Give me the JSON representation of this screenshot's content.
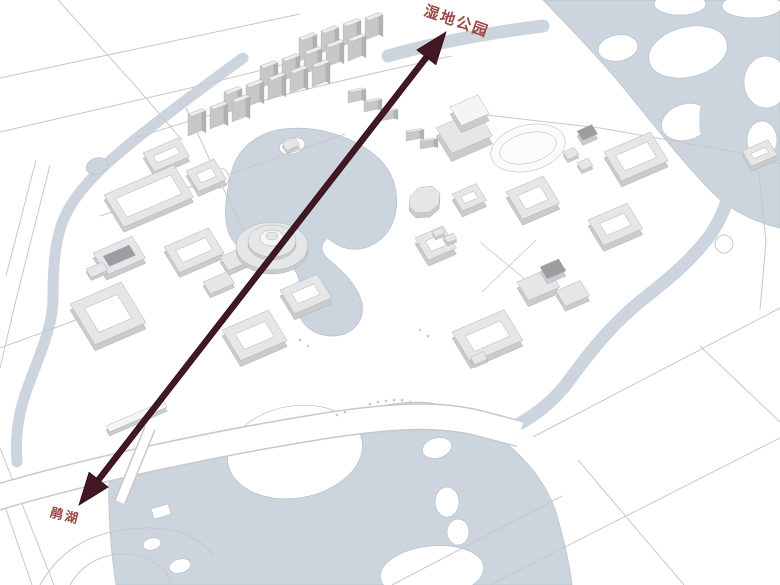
{
  "map": {
    "labels": {
      "wetland_park": "湿地公园",
      "juan_lake": "鹃湖"
    },
    "colors": {
      "background": "#ffffff",
      "water": "#ccd5de",
      "water_edge": "#b7c1cb",
      "road": "#c6c8ca",
      "arrow": "#431824",
      "arrow_outline": "#2c0e16",
      "label_text": "#9a4843",
      "building_face": "#e4e6e7",
      "building_top": "#f4f5f5",
      "building_side": "#c9cbcd",
      "building_dark": "#9b9da0"
    }
  }
}
